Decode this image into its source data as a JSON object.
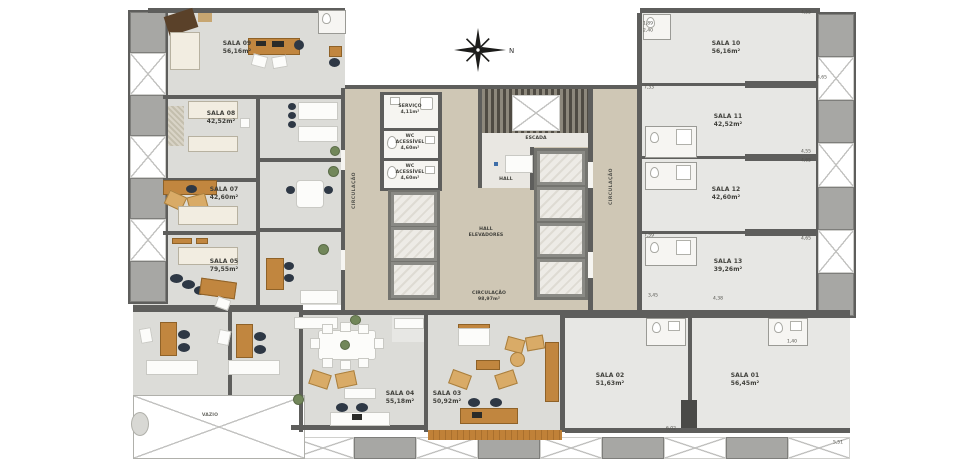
{
  "rooms": [
    {
      "name": "SALA 01",
      "area": "56,45m²"
    },
    {
      "name": "SALA 02",
      "area": "51,63m²"
    },
    {
      "name": "SALA 03",
      "area": "50,92m²"
    },
    {
      "name": "SALA 04",
      "area": "55,18m²"
    },
    {
      "name": "SALA 05",
      "area": "79,55m²"
    },
    {
      "name": "SALA 07",
      "area": "42,60m²"
    },
    {
      "name": "SALA 08",
      "area": "42,52m²"
    },
    {
      "name": "SALA 09",
      "area": "56,16m²"
    },
    {
      "name": "SALA 10",
      "area": "56,16m²"
    },
    {
      "name": "SALA 11",
      "area": "42,52m²"
    },
    {
      "name": "SALA 12",
      "area": "42,60m²"
    },
    {
      "name": "SALA 13",
      "area": "39,26m²"
    }
  ],
  "service": {
    "servico": {
      "name": "SERVIÇO",
      "area": "4,11m²"
    },
    "wc1": {
      "name": "WC\nACESSÍVEL",
      "area": "4,60m²"
    },
    "wc2": {
      "name": "WC\nACESSÍVEL",
      "area": "4,60m²"
    }
  },
  "zones": {
    "escada": "ESCADA",
    "hall": "HALL",
    "hall_elevadores": "HALL\nELEVADORES",
    "circulacao_central": {
      "name": "CIRCULAÇÃO",
      "area": "98,97m²"
    },
    "circulacao_left": "CIRCULAÇÃO",
    "circulacao_right": "CIRCULAÇÃO",
    "vazio": "VAZIO"
  },
  "compass": {
    "north_label": "N"
  },
  "dimensions": [
    "4,55",
    "1,89",
    "2,40",
    "7,33",
    "4,65",
    "4,55",
    "4,65",
    "7,59",
    "4,65",
    "3,45",
    "4,38",
    "1,40",
    "6,02",
    "5,51"
  ],
  "colors": {
    "wall": "#5e5e5c",
    "floor": "#dcdcd8",
    "floor_light": "#e7e7e4",
    "corridor": "#cfc7b5",
    "wood": "#c1863f",
    "chair_dark": "#2e3845",
    "bed": "#f2ede1",
    "slab": "#a7a7a4",
    "plant": "#72875a"
  }
}
